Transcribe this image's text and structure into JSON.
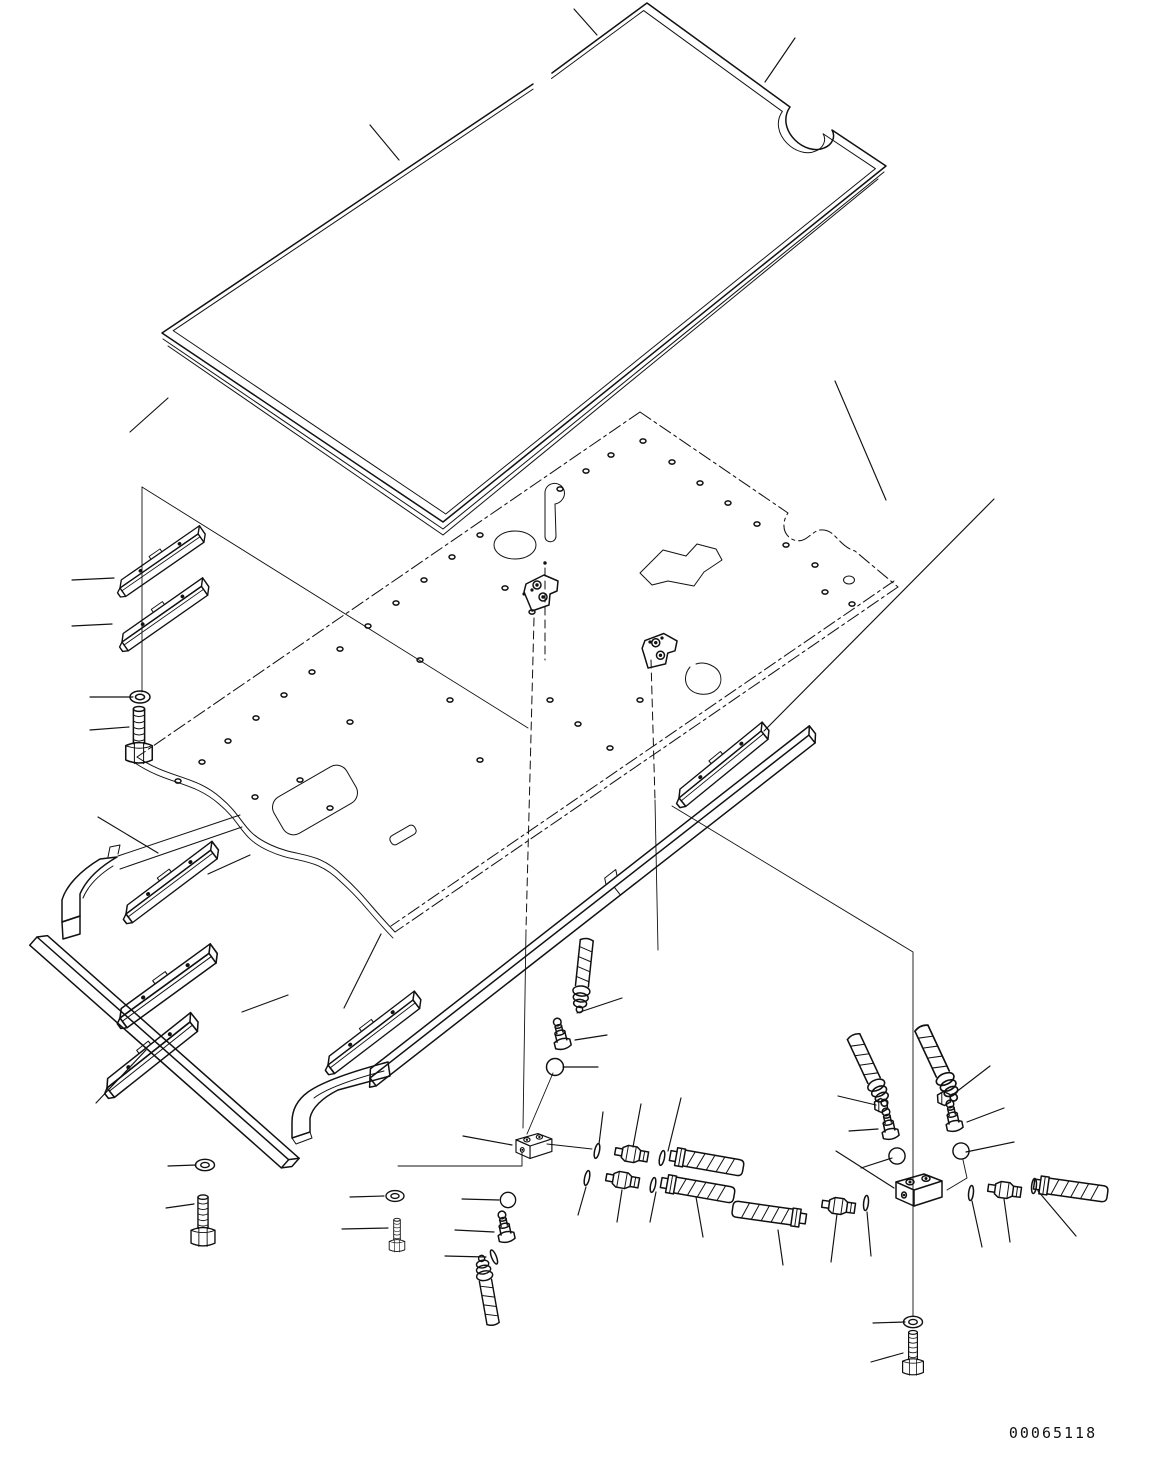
{
  "document": {
    "type_label": "exploded parts diagram",
    "drawing_number": "00065118"
  },
  "canvas": {
    "background": "#ffffff",
    "ink": "#111111"
  }
}
